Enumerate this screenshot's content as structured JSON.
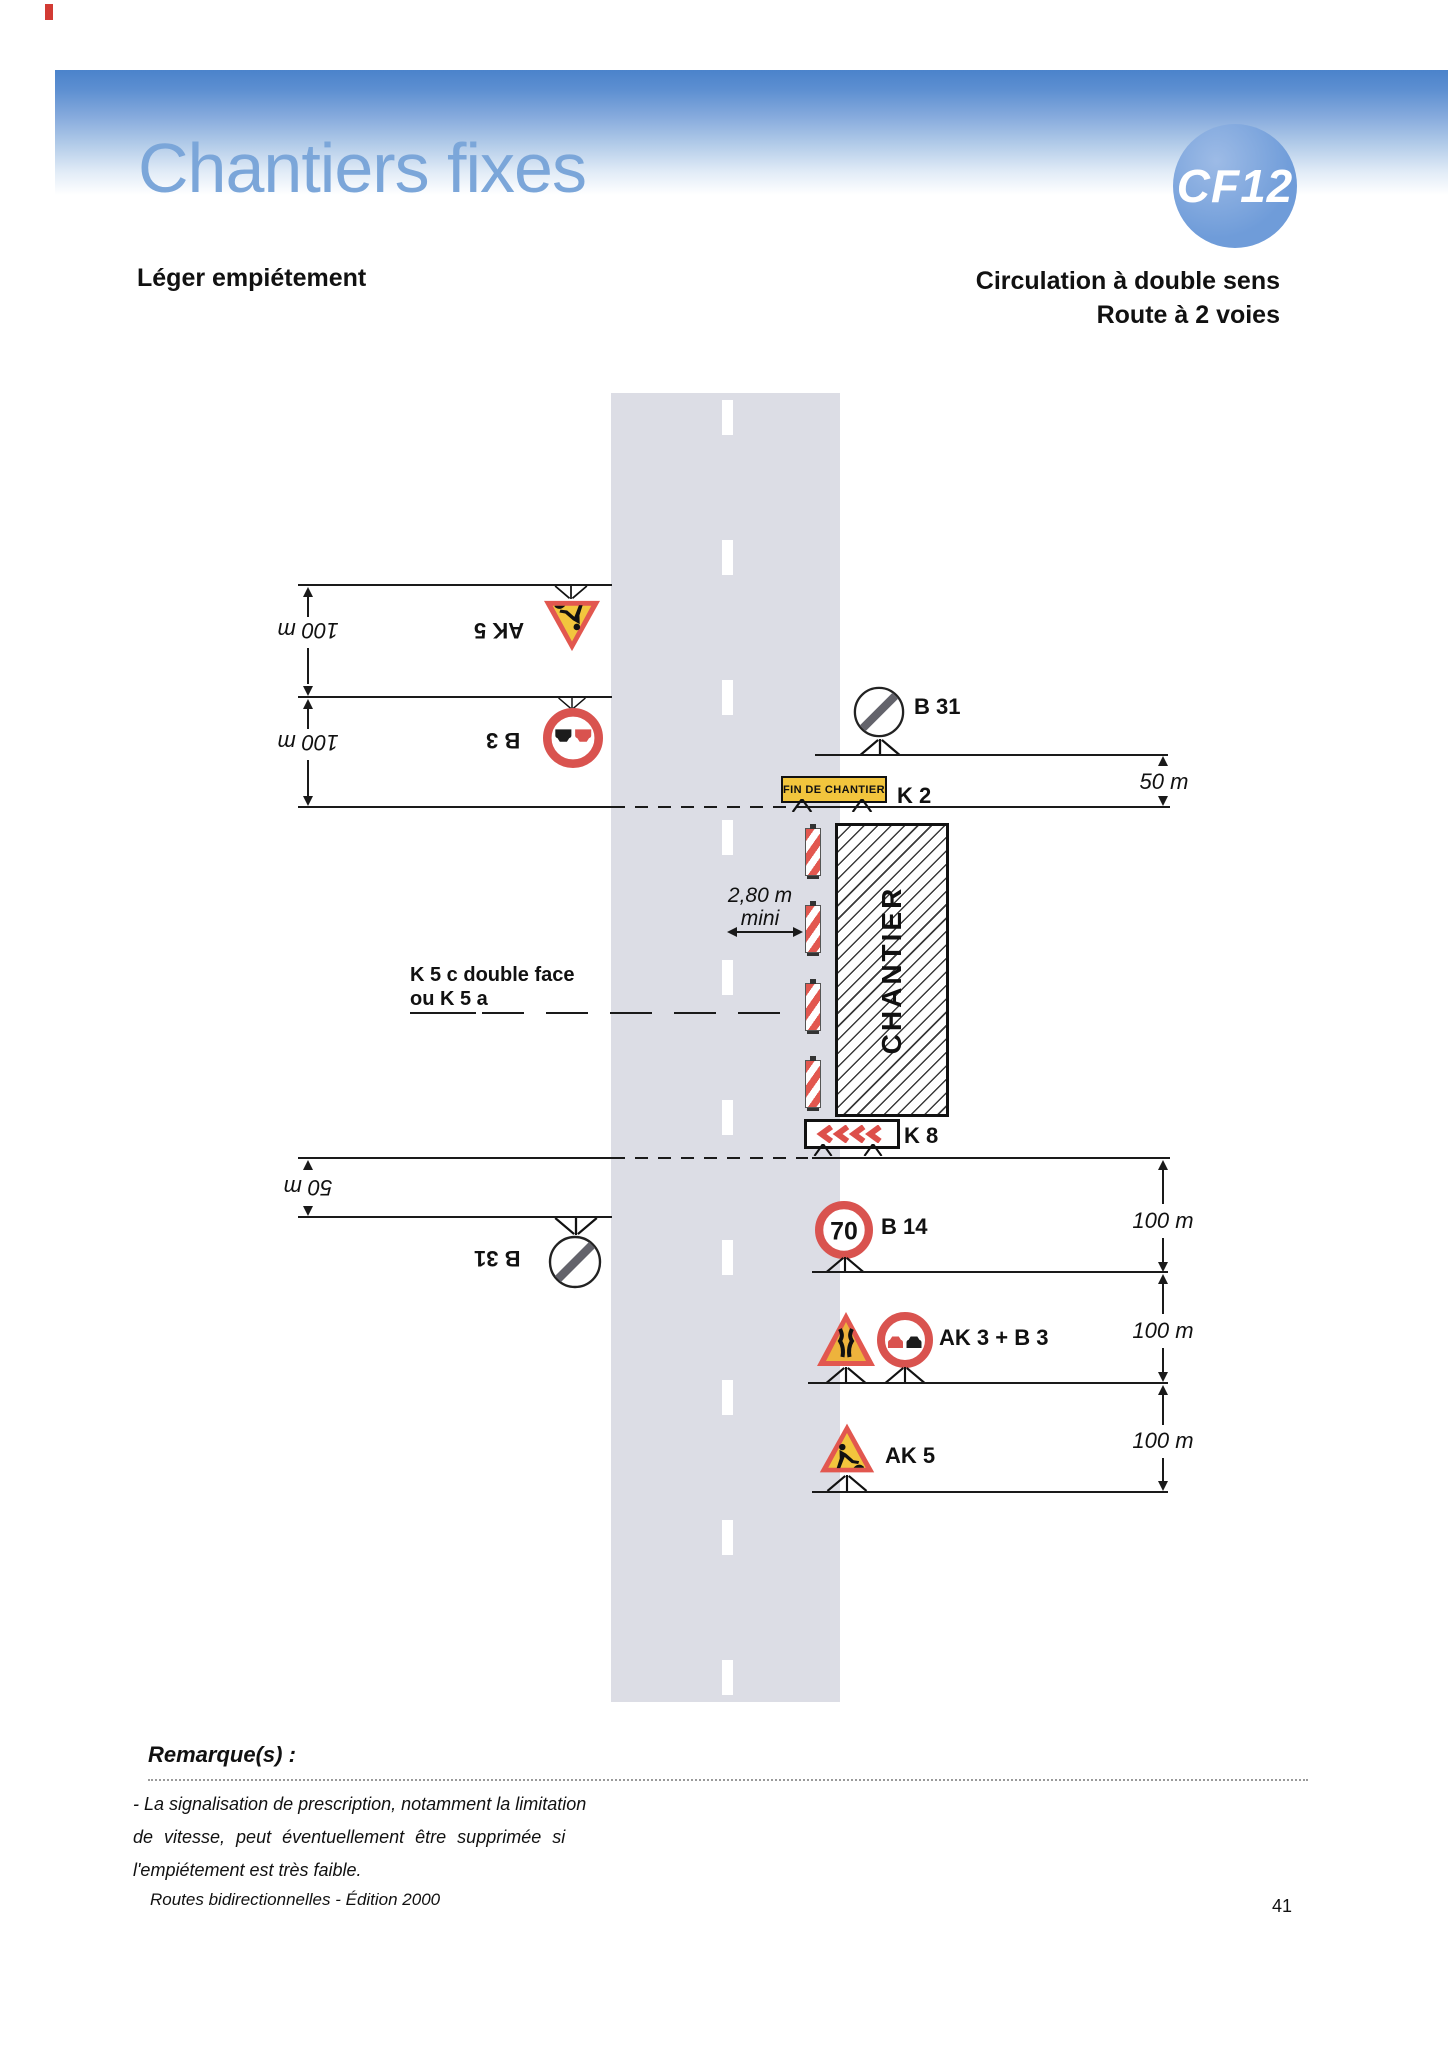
{
  "header": {
    "title": "Chantiers fixes",
    "badge_label": "CF12",
    "subtitle_left": "Léger empiétement",
    "subtitle_right": {
      "line1": "Circulation à double sens",
      "line2": "Route à 2 voies"
    }
  },
  "diagram": {
    "labels": {
      "ak5_top": "AK 5",
      "b3_top": "B 3",
      "b31_left": "B 31",
      "b31_right": "B 31",
      "k2": "K 2",
      "k8": "K 8",
      "b14": "B 14",
      "ak3_b3": "AK 3 + B 3",
      "ak5_bottom": "AK 5"
    },
    "sign_values": {
      "b14_speed": "70"
    },
    "panels": {
      "k2_text": "FIN DE CHANTIER",
      "work_zone_text": "CHANTIER"
    },
    "dimensions": {
      "left_top1": "100 m",
      "left_top2": "100 m",
      "left_bottom": "50 m",
      "right_top": "50 m",
      "right_b14": "100 m",
      "right_ak3b3": "100 m",
      "right_ak5": "100 m",
      "lane_gap_line1": "2,80 m",
      "lane_gap_line2": "mini"
    },
    "annotations": {
      "k5_line1": "K 5 c double face",
      "k5_line2": "ou K 5 a"
    }
  },
  "remarks": {
    "heading": "Remarque(s) :",
    "lines": [
      "- La signalisation de prescription, notamment la limitation",
      "de vitesse, peut éventuellement être supprimée si",
      "l'empiétement est très faible."
    ]
  },
  "footer": {
    "edition": "Routes bidirectionnelles - Édition 2000",
    "page_number": "41"
  },
  "colors": {
    "header_band_blue": "#4b83cb",
    "title_blue": "#7ba6d9",
    "badge_blue": "#6f9cd9",
    "road_gray": "#dcdde5",
    "sign_red": "#d9534f",
    "sign_yellow": "#f2c53d",
    "ak3_orange": "#eeb33c",
    "b31_slash_gray": "#63636b"
  }
}
